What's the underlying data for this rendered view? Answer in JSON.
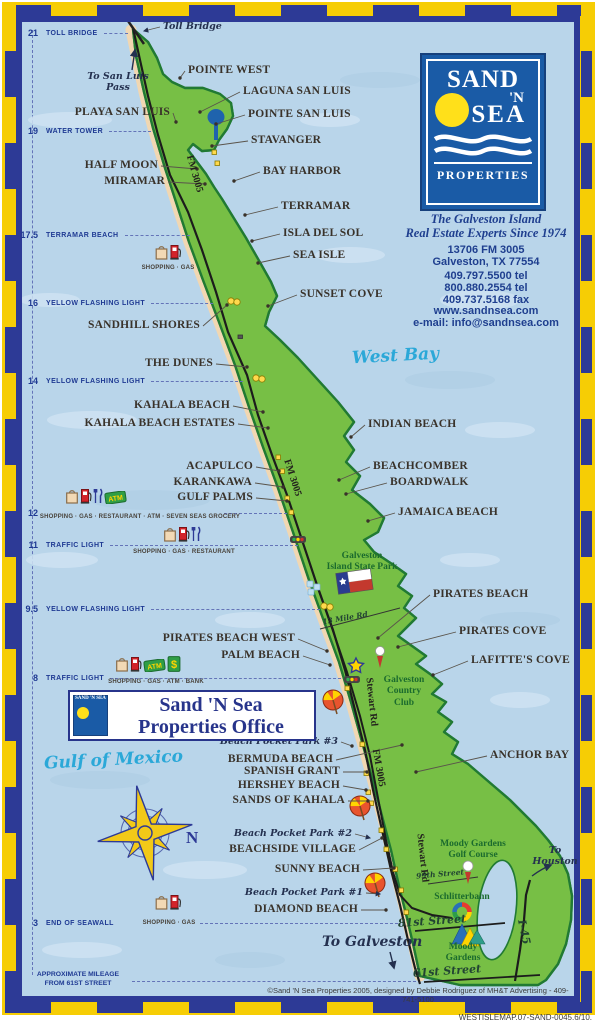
{
  "colors": {
    "border_navy": "#2d3a96",
    "border_yellow": "#f6cd05",
    "water": "#b9d5ea",
    "island_green": "#77bf45",
    "band_yellow": "#f6f2a2",
    "sand": "#f1d7b2",
    "outline_green": "#217a33",
    "logo_blue": "#1a5ba6",
    "sun_yellow": "#ffe01a",
    "navy_text": "#1f3f8f",
    "cyan_script": "#2ba8d8",
    "park_green": "#1b6b2e"
  },
  "logo_panel": {
    "brand_word1": "SAND",
    "brand_word2": "'N",
    "brand_word3": "SEA",
    "brand_word4": "PROPERTIES",
    "tagline": "The Galveston Island\nReal Estate Experts Since 1974",
    "address": "13706 FM 3005\nGalveston, TX 77554",
    "phones": "409.797.5500 tel\n800.880.2554 tel\n409.737.5168 fax",
    "website": "www.sandnsea.com",
    "email": "e-mail: info@sandnsea.com"
  },
  "office_banner": {
    "logo_text": "SAND 'N SEA",
    "line1": "Sand 'N Sea",
    "line2": "Properties Office"
  },
  "mileage_scale": {
    "markers": [
      {
        "mile": "21",
        "label": "TOLL BRIDGE",
        "y": 33
      },
      {
        "mile": "19",
        "label": "WATER TOWER",
        "y": 131
      },
      {
        "mile": "17.5",
        "label": "TERRAMAR BEACH",
        "y": 235
      },
      {
        "mile": "16",
        "label": "YELLOW FLASHING LIGHT",
        "y": 303
      },
      {
        "mile": "14",
        "label": "YELLOW FLASHING LIGHT",
        "y": 381
      },
      {
        "mile": "12",
        "label": "",
        "y": 513,
        "dash_from": 224
      },
      {
        "mile": "11",
        "label": "TRAFFIC LIGHT",
        "y": 545
      },
      {
        "mile": "9.5",
        "label": "YELLOW FLASHING LIGHT",
        "y": 609
      },
      {
        "mile": "8",
        "label": "TRAFFIC LIGHT",
        "y": 678
      },
      {
        "mile": "3",
        "label": "END OF SEAWALL",
        "y": 923,
        "dash_from": 200
      }
    ],
    "footnote": "APPROXIMATE MILEAGE\nFROM 61ST STREET"
  },
  "place_labels": [
    {
      "text": "POINTE WEST",
      "a": "l",
      "x": 188,
      "y": 65,
      "t": [
        180,
        78
      ]
    },
    {
      "text": "LAGUNA SAN LUIS",
      "a": "l",
      "x": 243,
      "y": 86,
      "t": [
        200,
        112
      ]
    },
    {
      "text": "PLAYA SAN LUIS",
      "a": "r",
      "x": 170,
      "y": 107,
      "t": [
        176,
        122
      ]
    },
    {
      "text": "POINTE SAN LUIS",
      "a": "l",
      "x": 248,
      "y": 109,
      "t": [
        216,
        124
      ]
    },
    {
      "text": "STAVANGER",
      "a": "l",
      "x": 251,
      "y": 135,
      "t": [
        212,
        146
      ]
    },
    {
      "text": "HALF MOON",
      "a": "r",
      "x": 158,
      "y": 160,
      "t": [
        197,
        169
      ]
    },
    {
      "text": "MIRAMAR",
      "a": "r",
      "x": 165,
      "y": 176,
      "t": [
        205,
        184
      ]
    },
    {
      "text": "BAY HARBOR",
      "a": "l",
      "x": 263,
      "y": 166,
      "t": [
        234,
        181
      ]
    },
    {
      "text": "TERRAMAR",
      "a": "l",
      "x": 281,
      "y": 201,
      "t": [
        245,
        215
      ]
    },
    {
      "text": "ISLA DEL SOL",
      "a": "l",
      "x": 283,
      "y": 228,
      "t": [
        252,
        241
      ]
    },
    {
      "text": "SEA ISLE",
      "a": "l",
      "x": 293,
      "y": 250,
      "t": [
        258,
        263
      ]
    },
    {
      "text": "SUNSET COVE",
      "a": "l",
      "x": 300,
      "y": 289,
      "t": [
        268,
        306
      ]
    },
    {
      "text": "SANDHILL SHORES",
      "a": "r",
      "x": 200,
      "y": 320,
      "t": [
        227,
        305
      ]
    },
    {
      "text": "THE DUNES",
      "a": "r",
      "x": 213,
      "y": 358,
      "t": [
        247,
        367
      ]
    },
    {
      "text": "KAHALA BEACH",
      "a": "r",
      "x": 230,
      "y": 400,
      "t": [
        263,
        412
      ]
    },
    {
      "text": "KAHALA BEACH ESTATES",
      "a": "r",
      "x": 235,
      "y": 418,
      "t": [
        268,
        428
      ]
    },
    {
      "text": "INDIAN BEACH",
      "a": "l",
      "x": 368,
      "y": 419,
      "t": [
        351,
        437
      ]
    },
    {
      "text": "ACAPULCO",
      "a": "r",
      "x": 253,
      "y": 461,
      "t": [
        279,
        471
      ]
    },
    {
      "text": "KARANKAWA",
      "a": "r",
      "x": 252,
      "y": 477,
      "t": [
        283,
        487
      ]
    },
    {
      "text": "GULF PALMS",
      "a": "r",
      "x": 253,
      "y": 492,
      "t": [
        287,
        501
      ]
    },
    {
      "text": "BEACHCOMBER",
      "a": "l",
      "x": 373,
      "y": 461,
      "t": [
        339,
        480
      ]
    },
    {
      "text": "BOARDWALK",
      "a": "l",
      "x": 390,
      "y": 477,
      "t": [
        346,
        494
      ]
    },
    {
      "text": "JAMAICA BEACH",
      "a": "l",
      "x": 398,
      "y": 507,
      "t": [
        368,
        521
      ]
    },
    {
      "text": "PIRATES BEACH",
      "a": "l",
      "x": 433,
      "y": 589,
      "t": [
        378,
        638
      ]
    },
    {
      "text": "PIRATES COVE",
      "a": "l",
      "x": 459,
      "y": 626,
      "t": [
        398,
        647
      ]
    },
    {
      "text": "LAFITTE'S COVE",
      "a": "l",
      "x": 471,
      "y": 655,
      "t": [
        433,
        675
      ]
    },
    {
      "text": "PIRATES BEACH WEST",
      "a": "r",
      "x": 295,
      "y": 633,
      "t": [
        327,
        651
      ]
    },
    {
      "text": "PALM BEACH",
      "a": "r",
      "x": 300,
      "y": 650,
      "t": [
        330,
        665
      ]
    },
    {
      "text": "ANCHOR BAY",
      "a": "l",
      "x": 490,
      "y": 750,
      "t": [
        416,
        772
      ]
    },
    {
      "text": "BERMUDA BEACH",
      "a": "r",
      "x": 333,
      "y": 754,
      "t": [
        402,
        745
      ]
    },
    {
      "text": "SPANISH GRANT",
      "a": "r",
      "x": 340,
      "y": 766,
      "t": [
        367,
        772
      ]
    },
    {
      "text": "HERSHEY BEACH",
      "a": "r",
      "x": 340,
      "y": 780,
      "t": [
        366,
        790
      ]
    },
    {
      "text": "SANDS OF KAHALA",
      "a": "r",
      "x": 345,
      "y": 795,
      "t": [
        368,
        801
      ]
    },
    {
      "text": "BEACHSIDE VILLAGE",
      "a": "r",
      "x": 356,
      "y": 844,
      "t": [
        382,
        838
      ]
    },
    {
      "text": "SUNNY BEACH",
      "a": "r",
      "x": 360,
      "y": 864,
      "t": [
        394,
        868
      ]
    },
    {
      "text": "DIAMOND BEACH",
      "a": "r",
      "x": 358,
      "y": 904,
      "t": [
        386,
        910
      ]
    }
  ],
  "script_labels": [
    {
      "text": "Toll Bridge",
      "a": "l",
      "x": 163,
      "y": 22,
      "t": [
        144,
        31
      ],
      "arrow": true
    },
    {
      "text": "To San Luis\nPass",
      "a": "c",
      "x": 118,
      "y": 72
    },
    {
      "text": "Beach Pocket Park #3",
      "a": "r",
      "x": 338,
      "y": 737,
      "t": [
        352,
        746
      ]
    },
    {
      "text": "Beach Pocket Park #2",
      "a": "r",
      "x": 352,
      "y": 829,
      "t": [
        370,
        838
      ],
      "arrow": true
    },
    {
      "text": "Beach Pocket Park #1",
      "a": "r",
      "x": 363,
      "y": 888,
      "t": [
        380,
        894
      ],
      "arrow": true
    },
    {
      "text": "To Galveston",
      "a": "l",
      "x": 322,
      "y": 934,
      "big": true
    },
    {
      "text": "To\nHouston",
      "a": "c",
      "x": 555,
      "y": 846
    }
  ],
  "water_labels": [
    {
      "text": "West Bay",
      "x": 352,
      "y": 348,
      "rot": -3
    },
    {
      "text": "Gulf of Mexico",
      "x": 44,
      "y": 752,
      "rot": -3
    }
  ],
  "park_labels": [
    {
      "text": "Galveston\nIsland State Park",
      "x": 362,
      "y": 551
    },
    {
      "text": "Galveston\nCountry\nClub",
      "x": 404,
      "y": 675
    },
    {
      "text": "Moody Gardens\nGolf Course",
      "x": 473,
      "y": 839
    },
    {
      "text": "Schlitterbahn",
      "x": 462,
      "y": 892
    },
    {
      "text": "Moody\nGardens",
      "x": 463,
      "y": 942
    }
  ],
  "road_labels": [
    {
      "text": "FM 3005",
      "x": 194,
      "y": 174,
      "rot": 74
    },
    {
      "text": "FM 3005",
      "x": 292,
      "y": 478,
      "rot": 72
    },
    {
      "text": "FM 3005",
      "x": 378,
      "y": 768,
      "rot": 80
    },
    {
      "text": "Stewart Rd",
      "x": 371,
      "y": 702,
      "rot": 84
    },
    {
      "text": "Stewart Rd",
      "x": 422,
      "y": 858,
      "rot": 84
    },
    {
      "text": "13 Mile Rd",
      "x": 345,
      "y": 618,
      "rot": -10,
      "script": true,
      "small": true
    },
    {
      "text": "99th Street",
      "x": 440,
      "y": 874,
      "rot": -5,
      "script": true,
      "small": true
    },
    {
      "text": "81st Street",
      "x": 432,
      "y": 921,
      "rot": -4,
      "script": true
    },
    {
      "text": "61st Street",
      "x": 447,
      "y": 971,
      "rot": -4,
      "script": true
    },
    {
      "text": "I-45",
      "x": 524,
      "y": 932,
      "rot": 78,
      "script": true
    }
  ],
  "amenities": [
    {
      "icons": [
        "bag",
        "pump"
      ],
      "icons_x": 168,
      "icons_y": 243,
      "caption": "SHOPPING · GAS",
      "caption_x": 168,
      "caption_y": 265
    },
    {
      "icons": [
        "bag",
        "pump",
        "fork",
        "atm"
      ],
      "icons_x": 96,
      "icons_y": 487,
      "caption": "SHOPPING · GAS · RESTAURANT · ATM · SEVEN SEAS GROCERY",
      "caption_x": 140,
      "caption_y": 514
    },
    {
      "icons": [
        "bag",
        "pump",
        "fork"
      ],
      "icons_x": 182,
      "icons_y": 525,
      "caption": "SHOPPING · GAS · RESTAURANT",
      "caption_x": 184,
      "caption_y": 549
    },
    {
      "icons": [
        "bag",
        "pump",
        "atm",
        "dollar"
      ],
      "icons_x": 148,
      "icons_y": 655,
      "caption": "SHOPPING · GAS · ATM · BANK",
      "caption_x": 156,
      "caption_y": 679
    },
    {
      "icons": [
        "bag",
        "pump"
      ],
      "icons_x": 168,
      "icons_y": 893,
      "caption": "SHOPPING · GAS",
      "caption_x": 169,
      "caption_y": 920
    }
  ],
  "icon_glyphs": {
    "atm": "ATM",
    "dollar": "$",
    "compass_north": "N"
  },
  "footer": {
    "credit": "©Sand 'N Sea Properties 2005, designed by Debbie Rodriguez of MH&T Advertising - 409-741-5100",
    "map_code": "WESTISLEMAP.07-SAND-0045.6/10."
  }
}
